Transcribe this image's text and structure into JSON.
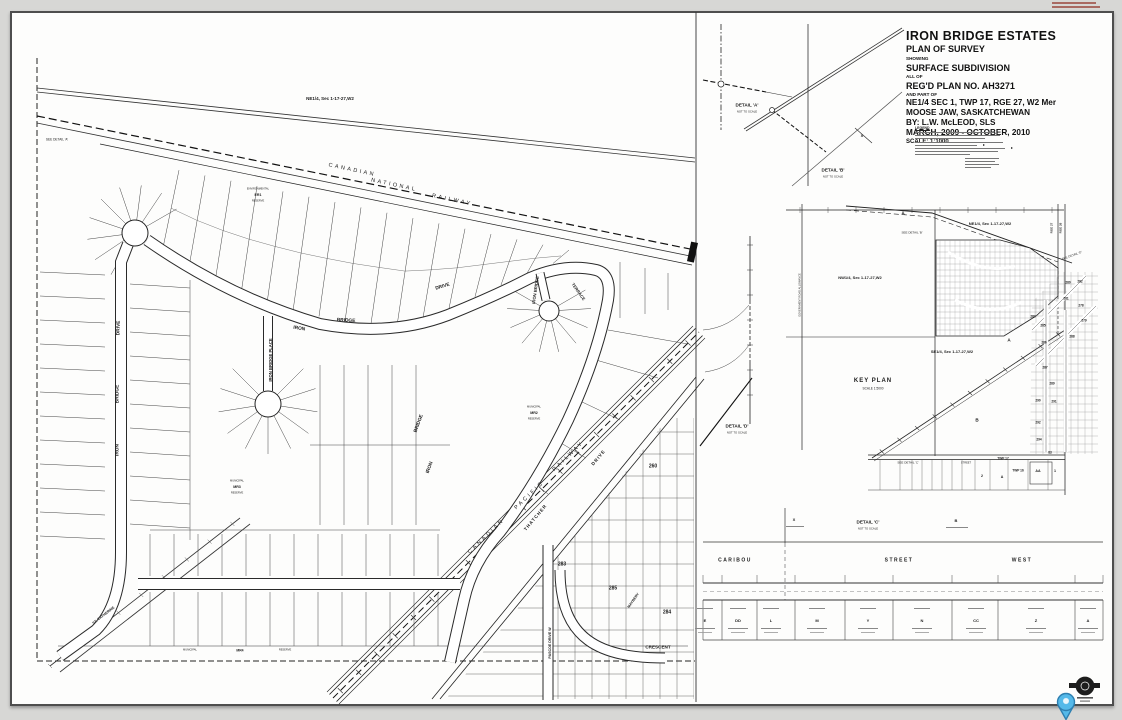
{
  "document": {
    "kind": "plan-of-survey-sheet",
    "colors": {
      "paper": "#fdfdfc",
      "ink": "#1c1c1c",
      "margin_gray": "#d7d7d5",
      "pin_blue": "#55b9e9",
      "pin_border": "#2e7fb0"
    }
  },
  "title_block": {
    "lines": [
      {
        "t": "IRON BRIDGE ESTATES",
        "c": "xl"
      },
      {
        "t": "PLAN OF SURVEY",
        "c": "l"
      },
      {
        "t": "SHOWING",
        "c": "s"
      },
      {
        "t": "SURFACE SUBDIVISION",
        "c": "l"
      },
      {
        "t": "ALL OF",
        "c": "s"
      },
      {
        "t": "REG'D PLAN NO. AH3271",
        "c": "l"
      },
      {
        "t": "AND PART OF",
        "c": "s"
      },
      {
        "t": "NE1/4 SEC 1, TWP 17, RGE 27, W2 Mer",
        "c": "m"
      },
      {
        "t": "MOOSE JAW, SASKATCHEWAN",
        "c": "m"
      },
      {
        "t": "BY:  L.W. McLEOD, SLS",
        "c": "m"
      },
      {
        "t": "MARCH, 2009 - OCTOBER, 2010",
        "c": "m"
      },
      {
        "t": "SCALE: 1:1000",
        "c": "sc"
      }
    ]
  },
  "legend": {
    "title": "LEGEND"
  },
  "labels": [
    {
      "t": "CANADIAN",
      "x": 352,
      "y": 171,
      "r": 12,
      "s": 5.5,
      "ls": 2.5
    },
    {
      "t": "NATIONAL",
      "x": 394,
      "y": 186,
      "r": 12,
      "s": 5.5,
      "ls": 2.5
    },
    {
      "t": "RAILWAY",
      "x": 452,
      "y": 201,
      "r": 12,
      "s": 5.5,
      "ls": 2.5
    },
    {
      "t": "NE1/4, Sec 1-17-27,W2",
      "x": 330,
      "y": 99,
      "s": 4.5,
      "b": 1
    },
    {
      "t": "SEE DETAIL 'A'",
      "x": 57,
      "y": 140,
      "s": 3.2
    },
    {
      "t": "IRON",
      "x": 299,
      "y": 330,
      "r": 9,
      "s": 4.8,
      "b": 1
    },
    {
      "t": "BRIDGE",
      "x": 346,
      "y": 322,
      "r": 3,
      "s": 4.8,
      "b": 1
    },
    {
      "t": "DRIVE",
      "x": 443,
      "y": 288,
      "r": -17,
      "s": 4.8,
      "b": 1
    },
    {
      "t": "DRIVE",
      "x": 120,
      "y": 328,
      "r": -88,
      "s": 4.8,
      "b": 1
    },
    {
      "t": "BRIDGE",
      "x": 119,
      "y": 394,
      "r": -90,
      "s": 4.8,
      "b": 1
    },
    {
      "t": "IRON",
      "x": 119,
      "y": 450,
      "r": -90,
      "s": 4.8,
      "b": 1
    },
    {
      "t": "IRON BRIDGE PLACE",
      "x": 271,
      "y": 360,
      "r": -90,
      "s": 4.2,
      "b": 1
    },
    {
      "t": "IRON BRIDGE",
      "x": 536,
      "y": 290,
      "r": -82,
      "s": 4.2,
      "b": 1
    },
    {
      "t": "TERRACE",
      "x": 578,
      "y": 292,
      "r": 55,
      "s": 4.2,
      "b": 1
    },
    {
      "t": "BRIDGE",
      "x": 420,
      "y": 424,
      "r": -70,
      "s": 4.8,
      "b": 1
    },
    {
      "t": "IRON",
      "x": 431,
      "y": 468,
      "r": -70,
      "s": 4.8,
      "b": 1
    },
    {
      "t": "CANADIAN",
      "x": 487,
      "y": 537,
      "r": -44,
      "s": 5.5,
      "ls": 2.5
    },
    {
      "t": "PACIFIC",
      "x": 530,
      "y": 496,
      "r": -44,
      "s": 5.5,
      "ls": 2.5
    },
    {
      "t": "RAILWAY",
      "x": 569,
      "y": 457,
      "r": -44,
      "s": 5.5,
      "ls": 2.5
    },
    {
      "t": "THATCHER",
      "x": 536,
      "y": 518,
      "r": -50,
      "s": 4.6,
      "b": 1,
      "ls": 1
    },
    {
      "t": "DRIVE",
      "x": 599,
      "y": 458,
      "r": -50,
      "s": 4.6,
      "b": 1,
      "ls": 1
    },
    {
      "t": "ST. CATHERINE",
      "x": 104,
      "y": 616,
      "r": -38,
      "s": 3.6,
      "b": 1
    },
    {
      "t": "PASCOE DRIVE W",
      "x": 551,
      "y": 643,
      "r": -90,
      "s": 3.6,
      "b": 1
    },
    {
      "t": "MAYBERY",
      "x": 634,
      "y": 601,
      "r": -55,
      "s": 3.6,
      "b": 1
    },
    {
      "t": "CRESCENT",
      "x": 658,
      "y": 648,
      "s": 4.6,
      "b": 1
    },
    {
      "t": "260",
      "x": 653,
      "y": 467,
      "s": 5,
      "b": 1
    },
    {
      "t": "283",
      "x": 562,
      "y": 565,
      "s": 5,
      "b": 1
    },
    {
      "t": "285",
      "x": 613,
      "y": 589,
      "s": 5,
      "b": 1
    },
    {
      "t": "284",
      "x": 667,
      "y": 613,
      "s": 5,
      "b": 1
    },
    {
      "t": "ENVIRONMENTAL",
      "x": 258,
      "y": 190,
      "s": 2.6
    },
    {
      "t": "ER1",
      "x": 258,
      "y": 196,
      "s": 3.6,
      "b": 1
    },
    {
      "t": "RESERVE",
      "x": 258,
      "y": 202,
      "s": 2.6
    },
    {
      "t": "MUNICIPAL",
      "x": 534,
      "y": 408,
      "s": 2.6
    },
    {
      "t": "MR2",
      "x": 534,
      "y": 414,
      "s": 3.6,
      "b": 1
    },
    {
      "t": "RESERVE",
      "x": 534,
      "y": 420,
      "s": 2.6
    },
    {
      "t": "MUNICIPAL",
      "x": 237,
      "y": 482,
      "s": 2.6
    },
    {
      "t": "MR3",
      "x": 237,
      "y": 488,
      "s": 3.6,
      "b": 1
    },
    {
      "t": "RESERVE",
      "x": 237,
      "y": 494,
      "s": 2.6
    },
    {
      "t": "MUNICIPAL",
      "x": 190,
      "y": 651,
      "s": 2.6
    },
    {
      "t": "MR4",
      "x": 240,
      "y": 651,
      "s": 3.4,
      "b": 1
    },
    {
      "t": "RESERVE",
      "x": 285,
      "y": 651,
      "s": 2.6
    },
    {
      "t": "DETAIL 'A'",
      "x": 747,
      "y": 106,
      "s": 4.6,
      "b": 1
    },
    {
      "t": "NOT TO SCALE",
      "x": 747,
      "y": 112,
      "s": 2.8
    },
    {
      "t": "DETAIL 'B'",
      "x": 833,
      "y": 171,
      "s": 4.6,
      "b": 1
    },
    {
      "t": "NOT TO SCALE",
      "x": 833,
      "y": 177,
      "s": 2.8
    },
    {
      "t": "X",
      "x": 862,
      "y": 136,
      "s": 4,
      "b": 1
    },
    {
      "t": "DETAIL 'D'",
      "x": 737,
      "y": 427,
      "s": 4.6,
      "b": 1
    },
    {
      "t": "NOT TO SCALE",
      "x": 737,
      "y": 433,
      "s": 2.8
    },
    {
      "t": "KEY PLAN",
      "x": 873,
      "y": 381,
      "s": 6,
      "b": 1,
      "ls": 1
    },
    {
      "t": "SCALE 1:5000",
      "x": 873,
      "y": 389,
      "s": 3.2
    },
    {
      "t": "NE1/4, Sec 1-17-27,W2",
      "x": 990,
      "y": 224,
      "s": 4,
      "b": 1
    },
    {
      "t": "NW1/4, Sec 1-17-27,W2",
      "x": 860,
      "y": 278,
      "s": 4,
      "b": 1
    },
    {
      "t": "SE1/4, Sec 1-17-27,W2",
      "x": 952,
      "y": 352,
      "s": 4,
      "b": 1
    },
    {
      "t": "SEE DETAIL 'B'",
      "x": 912,
      "y": 233,
      "s": 3
    },
    {
      "t": "SEE DETAIL 'D'",
      "x": 1072,
      "y": 256,
      "r": -20,
      "s": 3
    },
    {
      "t": "SEE DETAIL 'C'",
      "x": 908,
      "y": 463,
      "s": 3
    },
    {
      "t": "A",
      "x": 903,
      "y": 214,
      "s": 4.6,
      "b": 1
    },
    {
      "t": "A",
      "x": 1009,
      "y": 341,
      "s": 4.6,
      "b": 1
    },
    {
      "t": "B",
      "x": 977,
      "y": 421,
      "s": 4.6,
      "b": 1
    },
    {
      "t": "GOVERNMENT ROAD ALLOWANCE",
      "x": 801,
      "y": 295,
      "r": -90,
      "s": 2.6
    },
    {
      "t": "RGE 27",
      "x": 1052,
      "y": 228,
      "r": -90,
      "s": 3,
      "b": 1
    },
    {
      "t": "RGE 26",
      "x": 1061,
      "y": 228,
      "r": -90,
      "s": 3,
      "b": 1
    },
    {
      "t": "TWP 17",
      "x": 1003,
      "y": 459,
      "s": 3.2,
      "b": 1
    },
    {
      "t": "TWP 16",
      "x": 1018,
      "y": 471,
      "s": 3.2,
      "b": 1
    },
    {
      "t": "AA",
      "x": 1038,
      "y": 472,
      "s": 3.6,
      "b": 1
    },
    {
      "t": "1",
      "x": 1055,
      "y": 472,
      "s": 3.6,
      "b": 1
    },
    {
      "t": "2",
      "x": 982,
      "y": 477,
      "s": 3.6,
      "b": 1
    },
    {
      "t": "A",
      "x": 1002,
      "y": 478,
      "s": 3.6,
      "b": 1
    },
    {
      "t": "STREET",
      "x": 966,
      "y": 464,
      "s": 2.6
    },
    {
      "t": "X",
      "x": 794,
      "y": 520,
      "s": 4,
      "b": 1
    },
    {
      "t": "DETAIL 'C'",
      "x": 868,
      "y": 523,
      "s": 4.6,
      "b": 1
    },
    {
      "t": "NOT TO SCALE",
      "x": 868,
      "y": 529,
      "s": 2.8
    },
    {
      "t": "B",
      "x": 956,
      "y": 521,
      "s": 4,
      "b": 1
    },
    {
      "t": "CARIBOU",
      "x": 735,
      "y": 561,
      "s": 5,
      "b": 1,
      "ls": 1.5
    },
    {
      "t": "STREET",
      "x": 899,
      "y": 561,
      "s": 5,
      "b": 1,
      "ls": 1.5
    },
    {
      "t": "WEST",
      "x": 1022,
      "y": 561,
      "s": 5,
      "b": 1,
      "ls": 1.5
    }
  ],
  "key_plan": {
    "block_numbers": [
      {
        "t": "280",
        "x": 1068,
        "y": 283
      },
      {
        "t": "282",
        "x": 1080,
        "y": 282
      },
      {
        "t": "281",
        "x": 1066,
        "y": 299
      },
      {
        "t": "278",
        "x": 1081,
        "y": 306
      },
      {
        "t": "279",
        "x": 1084,
        "y": 321
      },
      {
        "t": "283",
        "x": 1033,
        "y": 317
      },
      {
        "t": "288",
        "x": 1072,
        "y": 337
      },
      {
        "t": "285",
        "x": 1043,
        "y": 326
      },
      {
        "t": "286",
        "x": 1044,
        "y": 343
      },
      {
        "t": "287",
        "x": 1045,
        "y": 368
      },
      {
        "t": "289",
        "x": 1052,
        "y": 384
      },
      {
        "t": "290",
        "x": 1038,
        "y": 401
      },
      {
        "t": "291",
        "x": 1054,
        "y": 402
      },
      {
        "t": "292",
        "x": 1038,
        "y": 423
      },
      {
        "t": "294",
        "x": 1039,
        "y": 440
      },
      {
        "t": "83",
        "x": 1050,
        "y": 453
      }
    ]
  },
  "caribou_strip": {
    "parcels": [
      "E",
      "DD",
      "L",
      "M",
      "Y",
      "N",
      "CC",
      "Z",
      "A"
    ]
  }
}
